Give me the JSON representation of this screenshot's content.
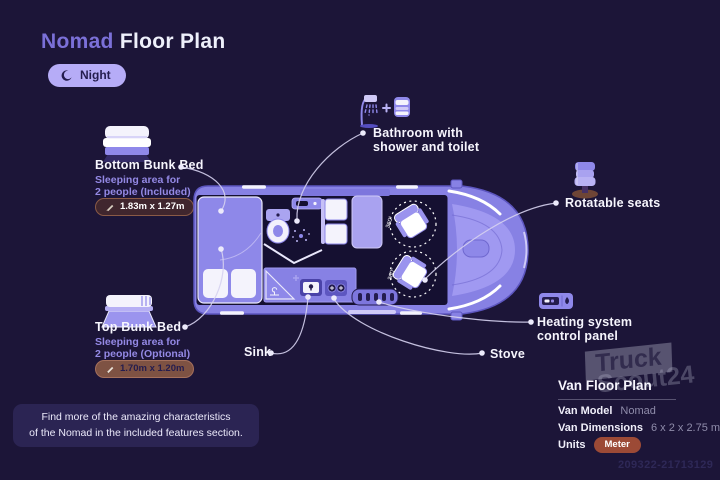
{
  "header": {
    "title_accent": "Nomad",
    "title_rest": "Floor Plan",
    "mode_badge": "Night"
  },
  "features": {
    "bottom_bunk": {
      "title": "Bottom Bunk Bed",
      "line1": "Sleeping area for",
      "line2": "2 people (Included)",
      "dimensions": "1.83m x 1.27m"
    },
    "top_bunk": {
      "title": "Top Bunk Bed",
      "line1": "Sleeping area for",
      "line2": "2 people (Optional)",
      "dimensions": "1.70m x 1.20m"
    },
    "bathroom": {
      "line1": "Bathroom with",
      "line2": "shower and toilet"
    },
    "rotatable_seats": {
      "label": "Rotatable seats"
    },
    "heating": {
      "line1": "Heating system",
      "line2": "control panel"
    },
    "sink": {
      "label": "Sink"
    },
    "stove": {
      "label": "Stove"
    }
  },
  "floor_plan": {
    "seat_rotation": "360°"
  },
  "info_panel": {
    "title": "Van Floor Plan",
    "rows": [
      {
        "label": "Van Model",
        "value": "Nomad"
      },
      {
        "label": "Van Dimensions",
        "value": "6 x 2 x 2.75 m"
      },
      {
        "label": "Units",
        "value": "Meter"
      }
    ]
  },
  "footer_note": {
    "line1": "Find more of the amazing characteristics",
    "line2": "of the Nomad in the included features section."
  },
  "watermark": {
    "line1": "Truck",
    "line2": "Scout24"
  },
  "ref_number": "209322-21713129",
  "colors": {
    "background": "#1c1538",
    "accent_purple": "#7b70d8",
    "van_body": "#8781e4",
    "interior_dark": "#151031",
    "furniture_light": "#a9a2f0",
    "white": "#f4f3fc",
    "subtext_purple": "#9489e5",
    "night_badge_bg": "#b6acf7",
    "pill_included_bg": "#40262e",
    "pill_optional_bg": "#7e5243",
    "meter_pill_bg": "#9c4a36",
    "leader_line": "#d6d2f0"
  }
}
